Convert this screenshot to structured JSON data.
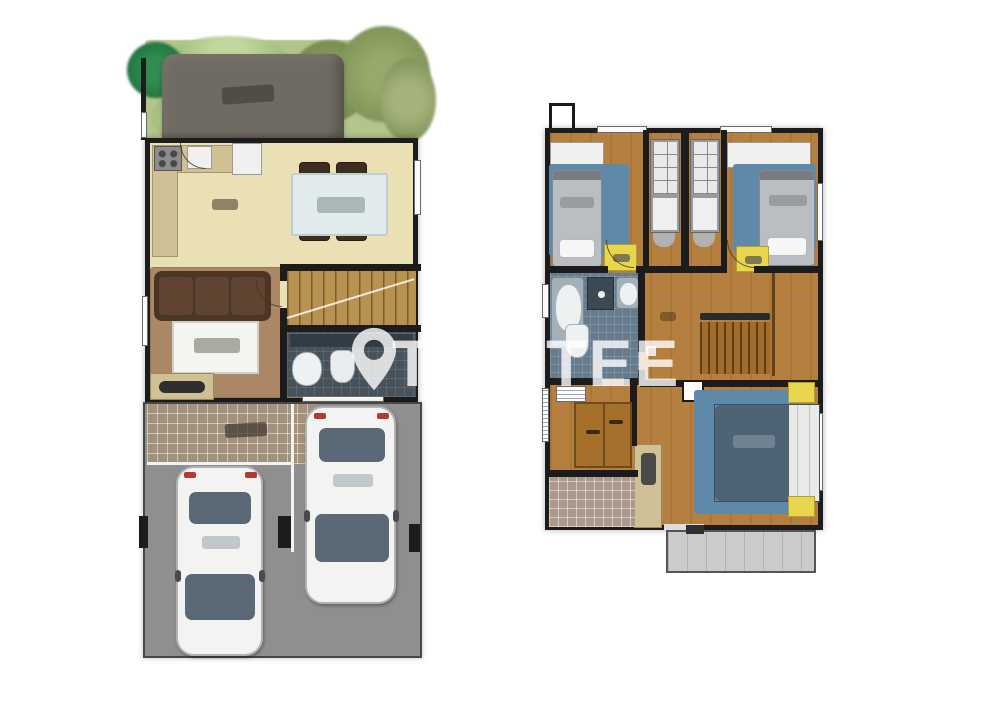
{
  "diagram": {
    "type": "floor-plan",
    "plan_count": 2,
    "micro_labels": "illegible-at-this-resolution"
  },
  "watermark": {
    "icon": "location-pin",
    "left_fragment": "T",
    "right_fragment": "TEE",
    "has_square_dot": true,
    "color": "#ffffff"
  },
  "plans": [
    {
      "name": "ground-floor",
      "areas": [
        "garden",
        "shed-pergola",
        "kitchen",
        "dining-area",
        "living-area",
        "staircase",
        "bathroom",
        "tiled-terrace",
        "garage-driveway"
      ],
      "furniture": [
        "stove",
        "kitchen-sink",
        "fridge",
        "dining-table",
        "dining-chairs-x4",
        "sofa",
        "coffee-table",
        "tv-console",
        "washbasin",
        "toilet",
        "car",
        "car"
      ]
    },
    {
      "name": "upper-floor",
      "areas": [
        "bedroom-left",
        "bedroom-right",
        "wardrobe-niche",
        "bathroom",
        "hallway",
        "staircase",
        "master-bedroom",
        "loggia",
        "balcony"
      ],
      "furniture": [
        "single-bed",
        "single-bed",
        "white-wardrobe",
        "white-wardrobe",
        "gray-closet",
        "gray-closet",
        "nightstand-yellow-x4",
        "bathtub",
        "shower",
        "washbasin",
        "toilet",
        "double-bed",
        "dresser-cabinet",
        "brown-wardrobe",
        "shelf-unit"
      ]
    }
  ],
  "colors": {
    "bg": "#ffffff",
    "wall": "#1c1c1c",
    "floor": "#e9e0b4",
    "wood": "#b5803f",
    "rug": "#5e89a8",
    "bed": "#4e6374",
    "bath": "#667c8d",
    "bath-dark": "#47525b",
    "garage": "#8f8f8f",
    "terrace": "#a2917c",
    "shed": "#6f6b62",
    "grass": "#b3c48e",
    "yellow": "#e9d64f",
    "counter": "#cfc096",
    "sofa": "#4b3626",
    "rug-brown": "#ab8765",
    "stair": "#b9924f",
    "glass": "#5b6875",
    "car": "#f3f3f1",
    "wbrown": "#a5702c",
    "balcony": "#cbcbcb",
    "wm": "#ffffff"
  }
}
